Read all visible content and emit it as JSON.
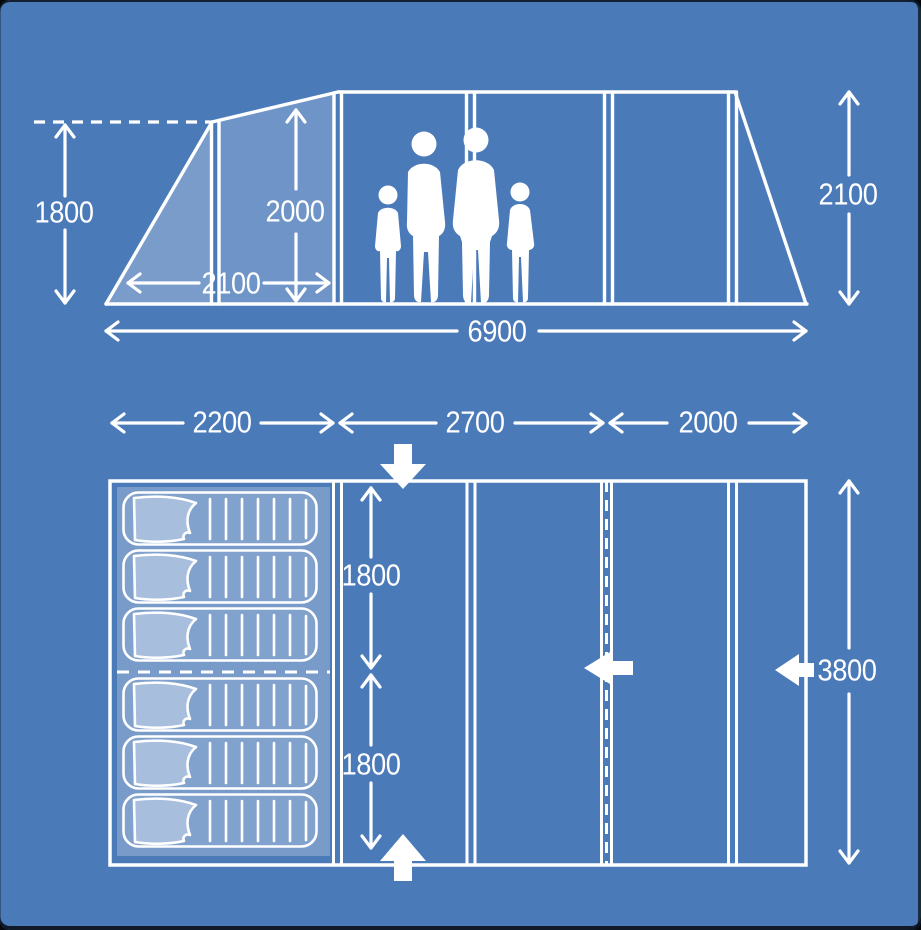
{
  "colors": {
    "background": "#4b7ab9",
    "line": "#ffffff",
    "panel_fill_light": "rgba(255,255,255,0.26)",
    "panel_fill": "rgba(255,255,255,0.21)",
    "frame_edge": "#121a25"
  },
  "side_view": {
    "dimensions": {
      "porch_height": "1800",
      "inner_height": "2000",
      "porch_depth": "2100",
      "total_length": "6900",
      "main_height": "2100"
    },
    "icons": {
      "family": "family-silhouette"
    }
  },
  "floor_plan": {
    "dimensions": {
      "bedroom_width": "2200",
      "living_width": "2700",
      "front_width": "2000",
      "bedroom_depth_top": "1800",
      "bedroom_depth_bottom": "1800",
      "total_depth": "3800"
    },
    "sleeping_bags": {
      "icon": "sleeping-bag",
      "count": 6
    },
    "entrance_arrows": {
      "icon": "entrance-arrow",
      "positions": [
        "top",
        "bottom",
        "center-left",
        "right"
      ]
    }
  }
}
